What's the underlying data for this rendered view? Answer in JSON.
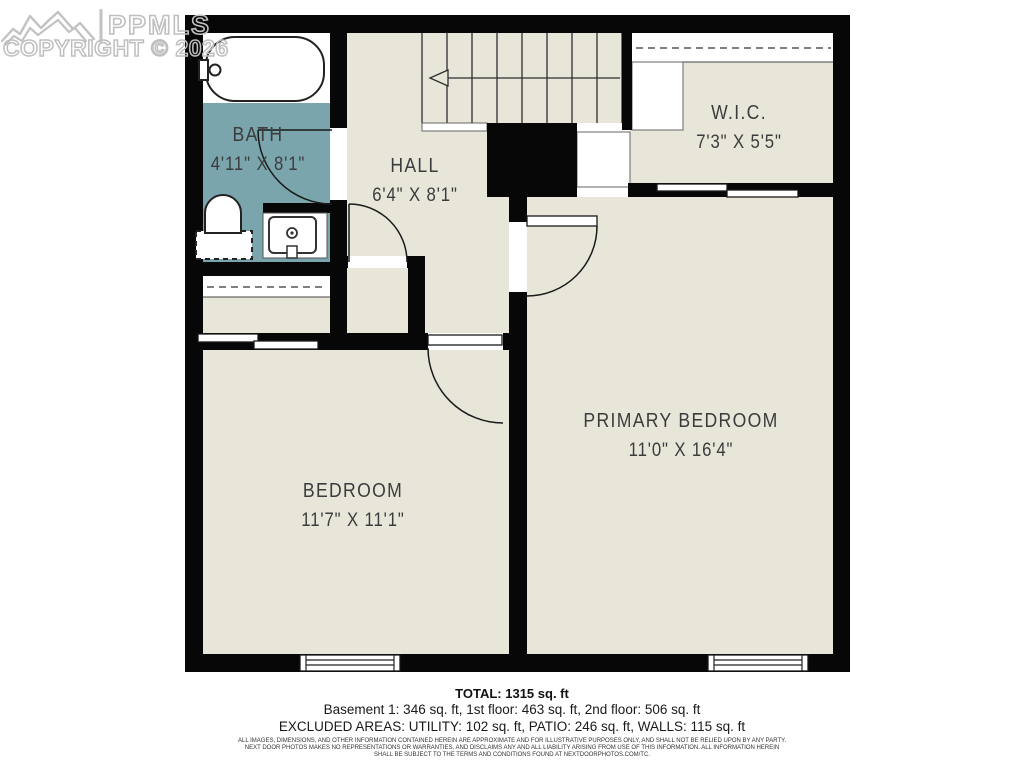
{
  "watermark": {
    "brand": "PPMLS",
    "copyright": "COPYRIGHT © 2026",
    "logo": "mountain-logo"
  },
  "colors": {
    "floor_beige": "#E8E5D9",
    "bath_teal": "#7AA5AD",
    "wall_black": "#070707",
    "label_gray": "#3C3C3C",
    "watermark_gray": "#BFBFBF",
    "background": "#FFFFFF"
  },
  "rooms": [
    {
      "id": "bath",
      "name": "BATH",
      "dimensions": "4'11\" X 8'1\""
    },
    {
      "id": "hall",
      "name": "HALL",
      "dimensions": "6'4\" X 8'1\""
    },
    {
      "id": "wic",
      "name": "W.I.C.",
      "dimensions": "7'3\" X 5'5\""
    },
    {
      "id": "primary-bedroom",
      "name": "PRIMARY BEDROOM",
      "dimensions": "11'0\" X 16'4\""
    },
    {
      "id": "bedroom",
      "name": "BEDROOM",
      "dimensions": "11'7\" X 11'1\""
    }
  ],
  "fixtures": [
    "bathtub",
    "toilet",
    "sink-vanity",
    "stairs-down-arrow",
    "closet-rod-wic",
    "closet-rod-bedroom"
  ],
  "summary": {
    "total": "TOTAL: 1315 sq. ft",
    "floors": "Basement 1: 346 sq. ft, 1st floor: 463 sq. ft, 2nd floor: 506 sq. ft",
    "excluded": "EXCLUDED AREAS: UTILITY: 102 sq. ft, PATIO: 246 sq. ft, WALLS: 115 sq. ft"
  },
  "disclaimer": {
    "line1": "ALL IMAGES, DIMENSIONS, AND OTHER INFORMATION CONTAINED HEREIN ARE APPROXIMATE AND FOR ILLUSTRATIVE PURPOSES ONLY, AND SHALL NOT BE RELIED UPON BY ANY PARTY.",
    "line2": "NEXT DOOR PHOTOS MAKES NO REPRESENTATIONS OR WARRANTIES, AND DISCLAIMS ANY AND ALL LIABILITY ARISING FROM USE OF THIS INFORMATION. ALL INFORMATION HEREIN",
    "line3": "SHALL BE SUBJECT TO THE TERMS AND CONDITIONS FOUND AT NEXTDOORPHOTOS.COM/TC."
  }
}
